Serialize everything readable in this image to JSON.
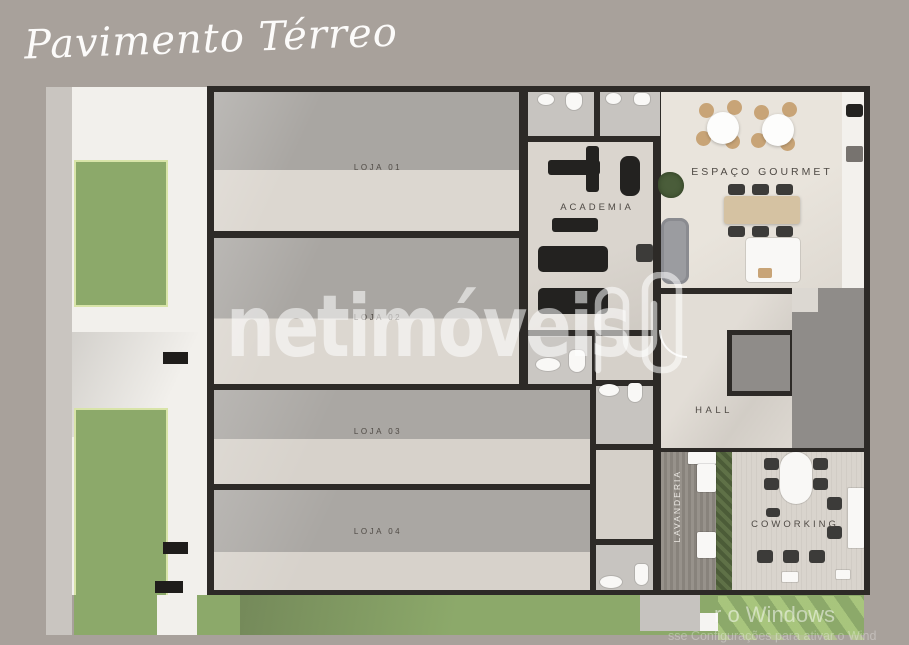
{
  "title": "Pavimento Térreo",
  "brand_watermark": {
    "name": "netimóveis",
    "logo": "netimoveis-n-logo"
  },
  "activation_watermark": {
    "line1": "r o Windows",
    "line2": "sse Configurações para ativar o Wind"
  },
  "rooms": {
    "loja_01": {
      "label": "LOJA 01"
    },
    "loja_02": {
      "label": "LOJA 02"
    },
    "loja_03": {
      "label": "LOJA 03"
    },
    "loja_04": {
      "label": "LOJA 04"
    },
    "academia": {
      "label": "ACADEMIA"
    },
    "espaco_gourmet": {
      "label": "ESPAÇO GOURMET"
    },
    "hall": {
      "label": "HALL"
    },
    "lavanderia": {
      "label": "LAVANDERIA"
    },
    "coworking": {
      "label": "COWORKING"
    }
  },
  "colors": {
    "background": "#a8a19b",
    "sidewalk": "#f2f0ec",
    "grass": "#8ca96a",
    "wall": "#2d2a27",
    "floor_dark": "#a9a6a2",
    "floor_light": "#dcd7d0",
    "floor_cream": "#e7e2da",
    "gray_block": "#8f8c89",
    "wood_table": "#d5c2a2"
  }
}
